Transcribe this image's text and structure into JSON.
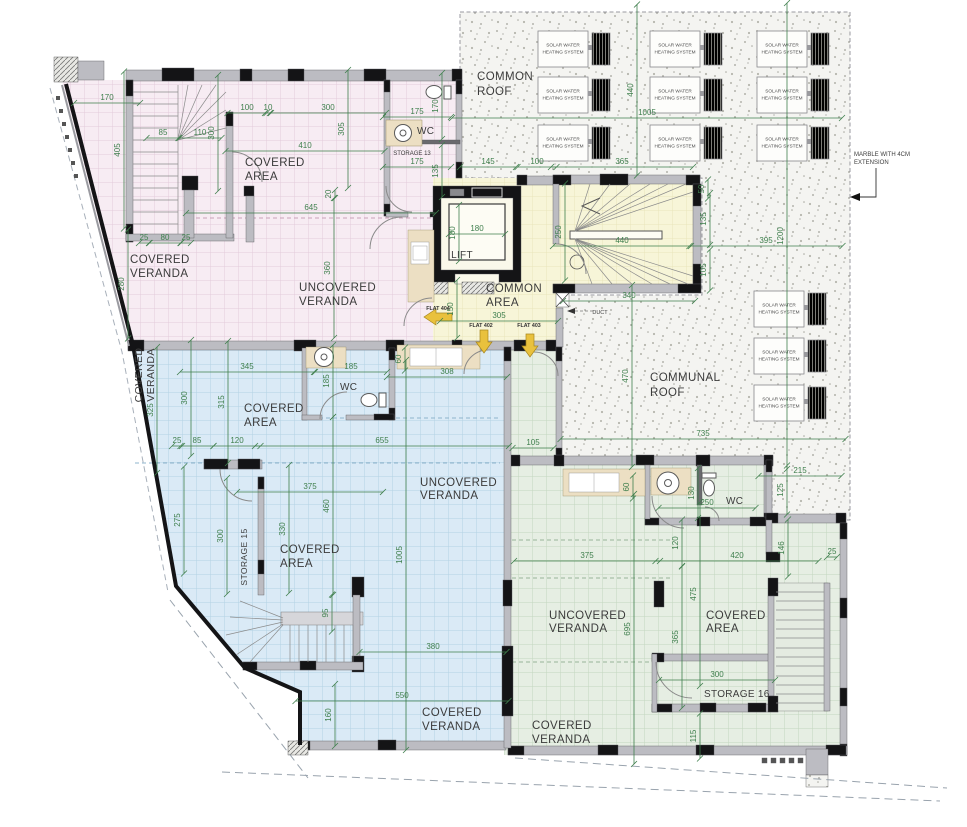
{
  "rooms": {
    "common_roof": {
      "l1": "COMMON",
      "l2": "ROOF"
    },
    "communal_roof": {
      "l1": "COMMUNAL",
      "l2": "ROOF"
    },
    "common_area": {
      "l1": "COMMON",
      "l2": "AREA"
    },
    "lift": "LIFT",
    "duct": "DUCT",
    "pink_covered_area": {
      "l1": "COVERED",
      "l2": "AREA"
    },
    "pink_covered_veranda": {
      "l1": "COVERED",
      "l2": "VERANDA"
    },
    "pink_uncovered_veranda": {
      "l1": "UNCOVERED",
      "l2": "VERANDA"
    },
    "pink_wc": "WC",
    "storage_13": "STORAGE 13",
    "blue_covered_veranda_side": {
      "l1": "COVERED",
      "l2": "VERANDA"
    },
    "blue_wc": "WC",
    "blue_covered_area_1": {
      "l1": "COVERED",
      "l2": "AREA"
    },
    "blue_uncovered_veranda": {
      "l1": "UNCOVERED",
      "l2": "VERANDA"
    },
    "storage_15": "STORAGE 15",
    "blue_covered_area_2": {
      "l1": "COVERED",
      "l2": "AREA"
    },
    "blue_covered_veranda_bottom": {
      "l1": "COVERED",
      "l2": "VERANDA"
    },
    "green_uncovered_veranda": {
      "l1": "UNCOVERED",
      "l2": "VERANDA"
    },
    "green_covered_area": {
      "l1": "COVERED",
      "l2": "AREA"
    },
    "green_wc": "WC",
    "storage_16": "STORAGE 16",
    "green_covered_veranda": {
      "l1": "COVERED",
      "l2": "VERANDA"
    }
  },
  "notes": {
    "marble_l1": "MARBLE WITH 4CM",
    "marble_l2": "EXTENSION"
  },
  "flats": {
    "f404": "FLAT 404",
    "f402": "FLAT 402",
    "f403": "FLAT 403"
  },
  "solar_panels": {
    "l1": "SOLAR WATER",
    "l2": "HEATING SYSTEM",
    "positions": [
      [
        538,
        31
      ],
      [
        650,
        31
      ],
      [
        757,
        31
      ],
      [
        538,
        77
      ],
      [
        650,
        77
      ],
      [
        757,
        77
      ],
      [
        538,
        125
      ],
      [
        650,
        125
      ],
      [
        757,
        125
      ],
      [
        754,
        291
      ],
      [
        754,
        338
      ],
      [
        754,
        385
      ]
    ]
  },
  "colors": {
    "dimension": "#3f7f4d",
    "pink": "#f7ecf3",
    "blue": "#daeaf6",
    "green": "#e6eee3",
    "yellow": "#f7f5d8",
    "arrow": "#e9c13d"
  },
  "dimensions": [
    {
      "v": "170",
      "x": 107,
      "y": 100,
      "o": "h"
    },
    {
      "v": "405",
      "x": 120,
      "y": 150,
      "o": "v"
    },
    {
      "v": "85",
      "x": 163,
      "y": 135,
      "o": "h"
    },
    {
      "v": "110",
      "x": 200,
      "y": 135,
      "o": "h"
    },
    {
      "v": "300",
      "x": 214,
      "y": 133,
      "o": "v"
    },
    {
      "v": "100",
      "x": 247,
      "y": 110,
      "o": "h"
    },
    {
      "v": "10",
      "x": 268,
      "y": 110,
      "o": "h"
    },
    {
      "v": "300",
      "x": 328,
      "y": 110,
      "o": "h"
    },
    {
      "v": "305",
      "x": 344,
      "y": 129,
      "o": "v"
    },
    {
      "v": "410",
      "x": 305,
      "y": 148,
      "o": "h"
    },
    {
      "v": "645",
      "x": 311,
      "y": 210,
      "o": "h"
    },
    {
      "v": "25",
      "x": 144,
      "y": 240,
      "o": "h"
    },
    {
      "v": "80",
      "x": 165,
      "y": 240,
      "o": "h"
    },
    {
      "v": "25",
      "x": 186,
      "y": 240,
      "o": "h"
    },
    {
      "v": "280",
      "x": 124,
      "y": 284,
      "o": "v"
    },
    {
      "v": "360",
      "x": 330,
      "y": 268,
      "o": "v"
    },
    {
      "v": "20",
      "x": 331,
      "y": 194,
      "o": "v"
    },
    {
      "v": "175",
      "x": 417,
      "y": 114,
      "o": "h"
    },
    {
      "v": "170",
      "x": 438,
      "y": 106,
      "o": "v"
    },
    {
      "v": "175",
      "x": 417,
      "y": 164,
      "o": "h"
    },
    {
      "v": "135",
      "x": 438,
      "y": 171,
      "o": "v"
    },
    {
      "v": "180",
      "x": 477,
      "y": 231,
      "o": "h",
      "L": 56
    },
    {
      "v": "180",
      "x": 455,
      "y": 233,
      "o": "v",
      "L": 56
    },
    {
      "v": "250",
      "x": 561,
      "y": 232,
      "o": "v"
    },
    {
      "v": "440",
      "x": 622,
      "y": 243,
      "o": "h",
      "L": 138
    },
    {
      "v": "150",
      "x": 453,
      "y": 309,
      "o": "v"
    },
    {
      "v": "305",
      "x": 499,
      "y": 318,
      "o": "h"
    },
    {
      "v": "340",
      "x": 629,
      "y": 298,
      "o": "h"
    },
    {
      "v": "1005",
      "x": 647,
      "y": 115,
      "o": "h"
    },
    {
      "v": "440",
      "x": 633,
      "y": 90,
      "o": "v"
    },
    {
      "v": "145",
      "x": 488,
      "y": 164,
      "o": "h"
    },
    {
      "v": "100",
      "x": 537,
      "y": 164,
      "o": "h"
    },
    {
      "v": "365",
      "x": 622,
      "y": 164,
      "o": "h"
    },
    {
      "v": "50",
      "x": 704,
      "y": 189,
      "o": "v"
    },
    {
      "v": "135",
      "x": 706,
      "y": 219,
      "o": "v"
    },
    {
      "v": "105",
      "x": 706,
      "y": 270,
      "o": "v"
    },
    {
      "v": "395",
      "x": 766,
      "y": 243,
      "o": "h"
    },
    {
      "v": "1200",
      "x": 783,
      "y": 236,
      "o": "v"
    },
    {
      "v": "470",
      "x": 628,
      "y": 376,
      "o": "v"
    },
    {
      "v": "735",
      "x": 703,
      "y": 436,
      "o": "h"
    },
    {
      "v": "215",
      "x": 800,
      "y": 473,
      "o": "h"
    },
    {
      "v": "125",
      "x": 783,
      "y": 490,
      "o": "v"
    },
    {
      "v": "345",
      "x": 247,
      "y": 369,
      "o": "h"
    },
    {
      "v": "300",
      "x": 187,
      "y": 398,
      "o": "v"
    },
    {
      "v": "315",
      "x": 224,
      "y": 402,
      "o": "v"
    },
    {
      "v": "185",
      "x": 351,
      "y": 369,
      "o": "h"
    },
    {
      "v": "185",
      "x": 329,
      "y": 381,
      "o": "v"
    },
    {
      "v": "60",
      "x": 401,
      "y": 359,
      "o": "v"
    },
    {
      "v": "308",
      "x": 447,
      "y": 374,
      "o": "h"
    },
    {
      "v": "655",
      "x": 382,
      "y": 443,
      "o": "h"
    },
    {
      "v": "25",
      "x": 177,
      "y": 443,
      "o": "h"
    },
    {
      "v": "85",
      "x": 197,
      "y": 443,
      "o": "h"
    },
    {
      "v": "120",
      "x": 237,
      "y": 443,
      "o": "h"
    },
    {
      "v": "375",
      "x": 310,
      "y": 489,
      "o": "h"
    },
    {
      "v": "460",
      "x": 329,
      "y": 506,
      "o": "v"
    },
    {
      "v": "275",
      "x": 180,
      "y": 520,
      "o": "v"
    },
    {
      "v": "300",
      "x": 223,
      "y": 536,
      "o": "v"
    },
    {
      "v": "330",
      "x": 285,
      "y": 529,
      "o": "v"
    },
    {
      "v": "1005",
      "x": 402,
      "y": 555,
      "o": "v"
    },
    {
      "v": "325",
      "x": 153,
      "y": 410,
      "o": "v"
    },
    {
      "v": "95",
      "x": 328,
      "y": 613,
      "o": "v"
    },
    {
      "v": "380",
      "x": 433,
      "y": 649,
      "o": "h"
    },
    {
      "v": "550",
      "x": 402,
      "y": 698,
      "o": "h"
    },
    {
      "v": "160",
      "x": 331,
      "y": 715,
      "o": "v"
    },
    {
      "v": "105",
      "x": 533,
      "y": 445,
      "o": "h"
    },
    {
      "v": "60",
      "x": 629,
      "y": 487,
      "o": "v"
    },
    {
      "v": "130",
      "x": 694,
      "y": 493,
      "o": "v"
    },
    {
      "v": "250",
      "x": 707,
      "y": 505,
      "o": "h"
    },
    {
      "v": "120",
      "x": 678,
      "y": 543,
      "o": "v"
    },
    {
      "v": "375",
      "x": 587,
      "y": 558,
      "o": "h"
    },
    {
      "v": "420",
      "x": 737,
      "y": 558,
      "o": "h"
    },
    {
      "v": "146",
      "x": 784,
      "y": 548,
      "o": "v"
    },
    {
      "v": "25",
      "x": 832,
      "y": 554,
      "o": "h"
    },
    {
      "v": "475",
      "x": 696,
      "y": 594,
      "o": "v"
    },
    {
      "v": "365",
      "x": 678,
      "y": 637,
      "o": "v"
    },
    {
      "v": "695",
      "x": 630,
      "y": 629,
      "o": "v"
    },
    {
      "v": "300",
      "x": 717,
      "y": 677,
      "o": "h"
    },
    {
      "v": "115",
      "x": 696,
      "y": 736,
      "o": "v"
    }
  ]
}
